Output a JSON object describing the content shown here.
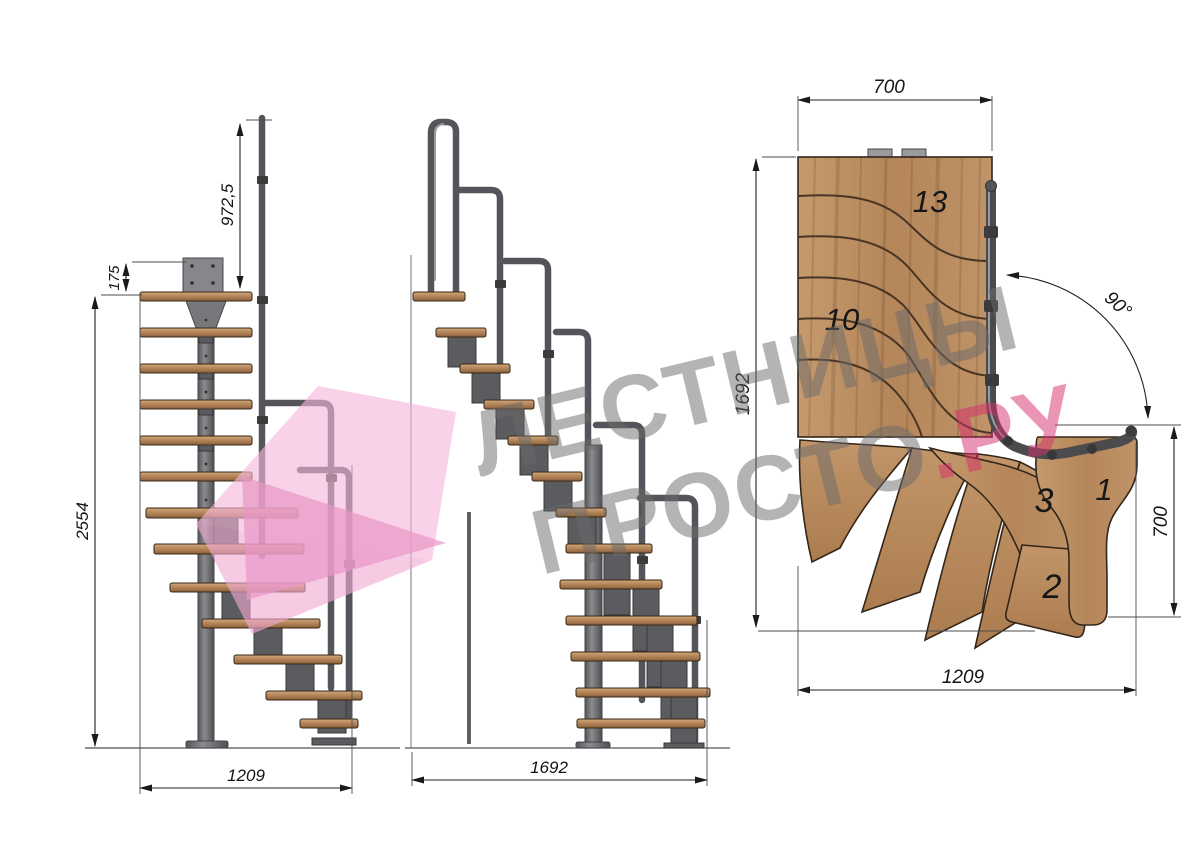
{
  "title": "Modular 90-degree staircase technical drawing",
  "views": {
    "front": {
      "name": "front-elevation",
      "dims": {
        "rail_height": "972,5",
        "landing_plate": "175",
        "total_height": "2554",
        "flight_width": "1209"
      }
    },
    "side": {
      "name": "side-elevation",
      "dims": {
        "flight_length": "1692"
      }
    },
    "plan": {
      "name": "plan-view",
      "dims": {
        "top_width": "700",
        "left_length": "1692",
        "right_depth": "700",
        "bottom_width": "1209",
        "turn_angle": "90°"
      },
      "tread_labels": {
        "t13": "13",
        "t10": "10",
        "t3": "3",
        "t1": "1",
        "t2": "2"
      }
    }
  },
  "watermark": {
    "line1": "ЛЕСТНИЦЫ",
    "line2": "ПРОСТО",
    "tld": ".РУ"
  },
  "colors": {
    "wood": "#b98a5f",
    "wood_light": "#cfa377",
    "wood_dark": "#8f6239",
    "metal": "#6a6b6e",
    "metal_dark": "#3c3c3f",
    "outline": "#33261a",
    "dimension_text": "#141414",
    "watermark_gray": "#6b6b6b",
    "watermark_pink": "#d62e6d",
    "logo_pink": "#f3aed7"
  }
}
